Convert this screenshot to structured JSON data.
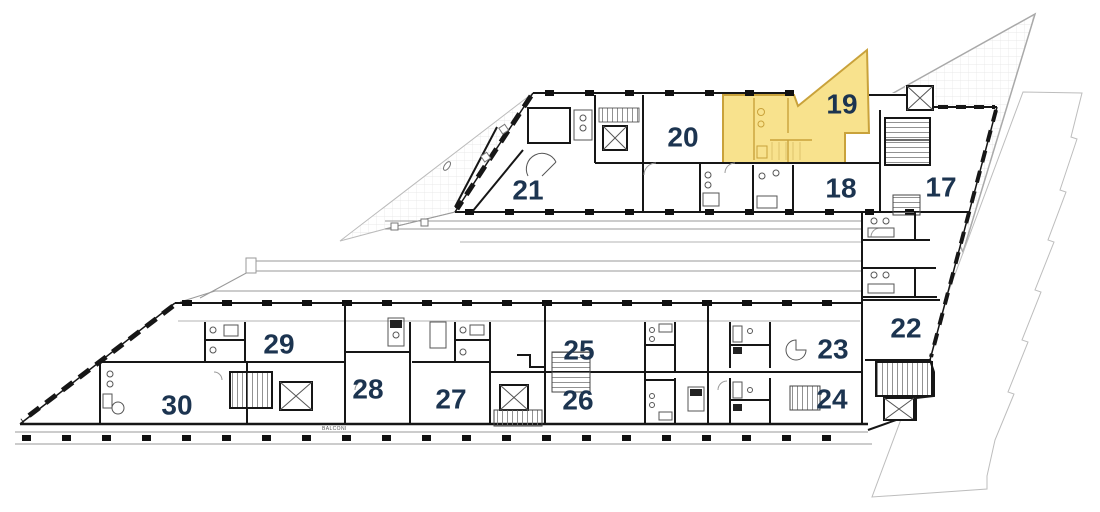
{
  "plan": {
    "type": "apartment-floor-plan",
    "highlighted_unit": "19",
    "balcony_label": "BALCONI",
    "colors": {
      "highlight_fill": "#F8E28D",
      "highlight_stroke": "#C9A23B",
      "label": "#1C3450",
      "wall": "#161616",
      "site_line": "#b5b5b5"
    },
    "units": [
      {
        "label": "17",
        "highlighted": false
      },
      {
        "label": "18",
        "highlighted": false
      },
      {
        "label": "19",
        "highlighted": true
      },
      {
        "label": "20",
        "highlighted": false
      },
      {
        "label": "21",
        "highlighted": false
      },
      {
        "label": "22",
        "highlighted": false
      },
      {
        "label": "23",
        "highlighted": false
      },
      {
        "label": "24",
        "highlighted": false
      },
      {
        "label": "25",
        "highlighted": false
      },
      {
        "label": "26",
        "highlighted": false
      },
      {
        "label": "27",
        "highlighted": false
      },
      {
        "label": "28",
        "highlighted": false
      },
      {
        "label": "29",
        "highlighted": false
      },
      {
        "label": "30",
        "highlighted": false
      }
    ]
  }
}
